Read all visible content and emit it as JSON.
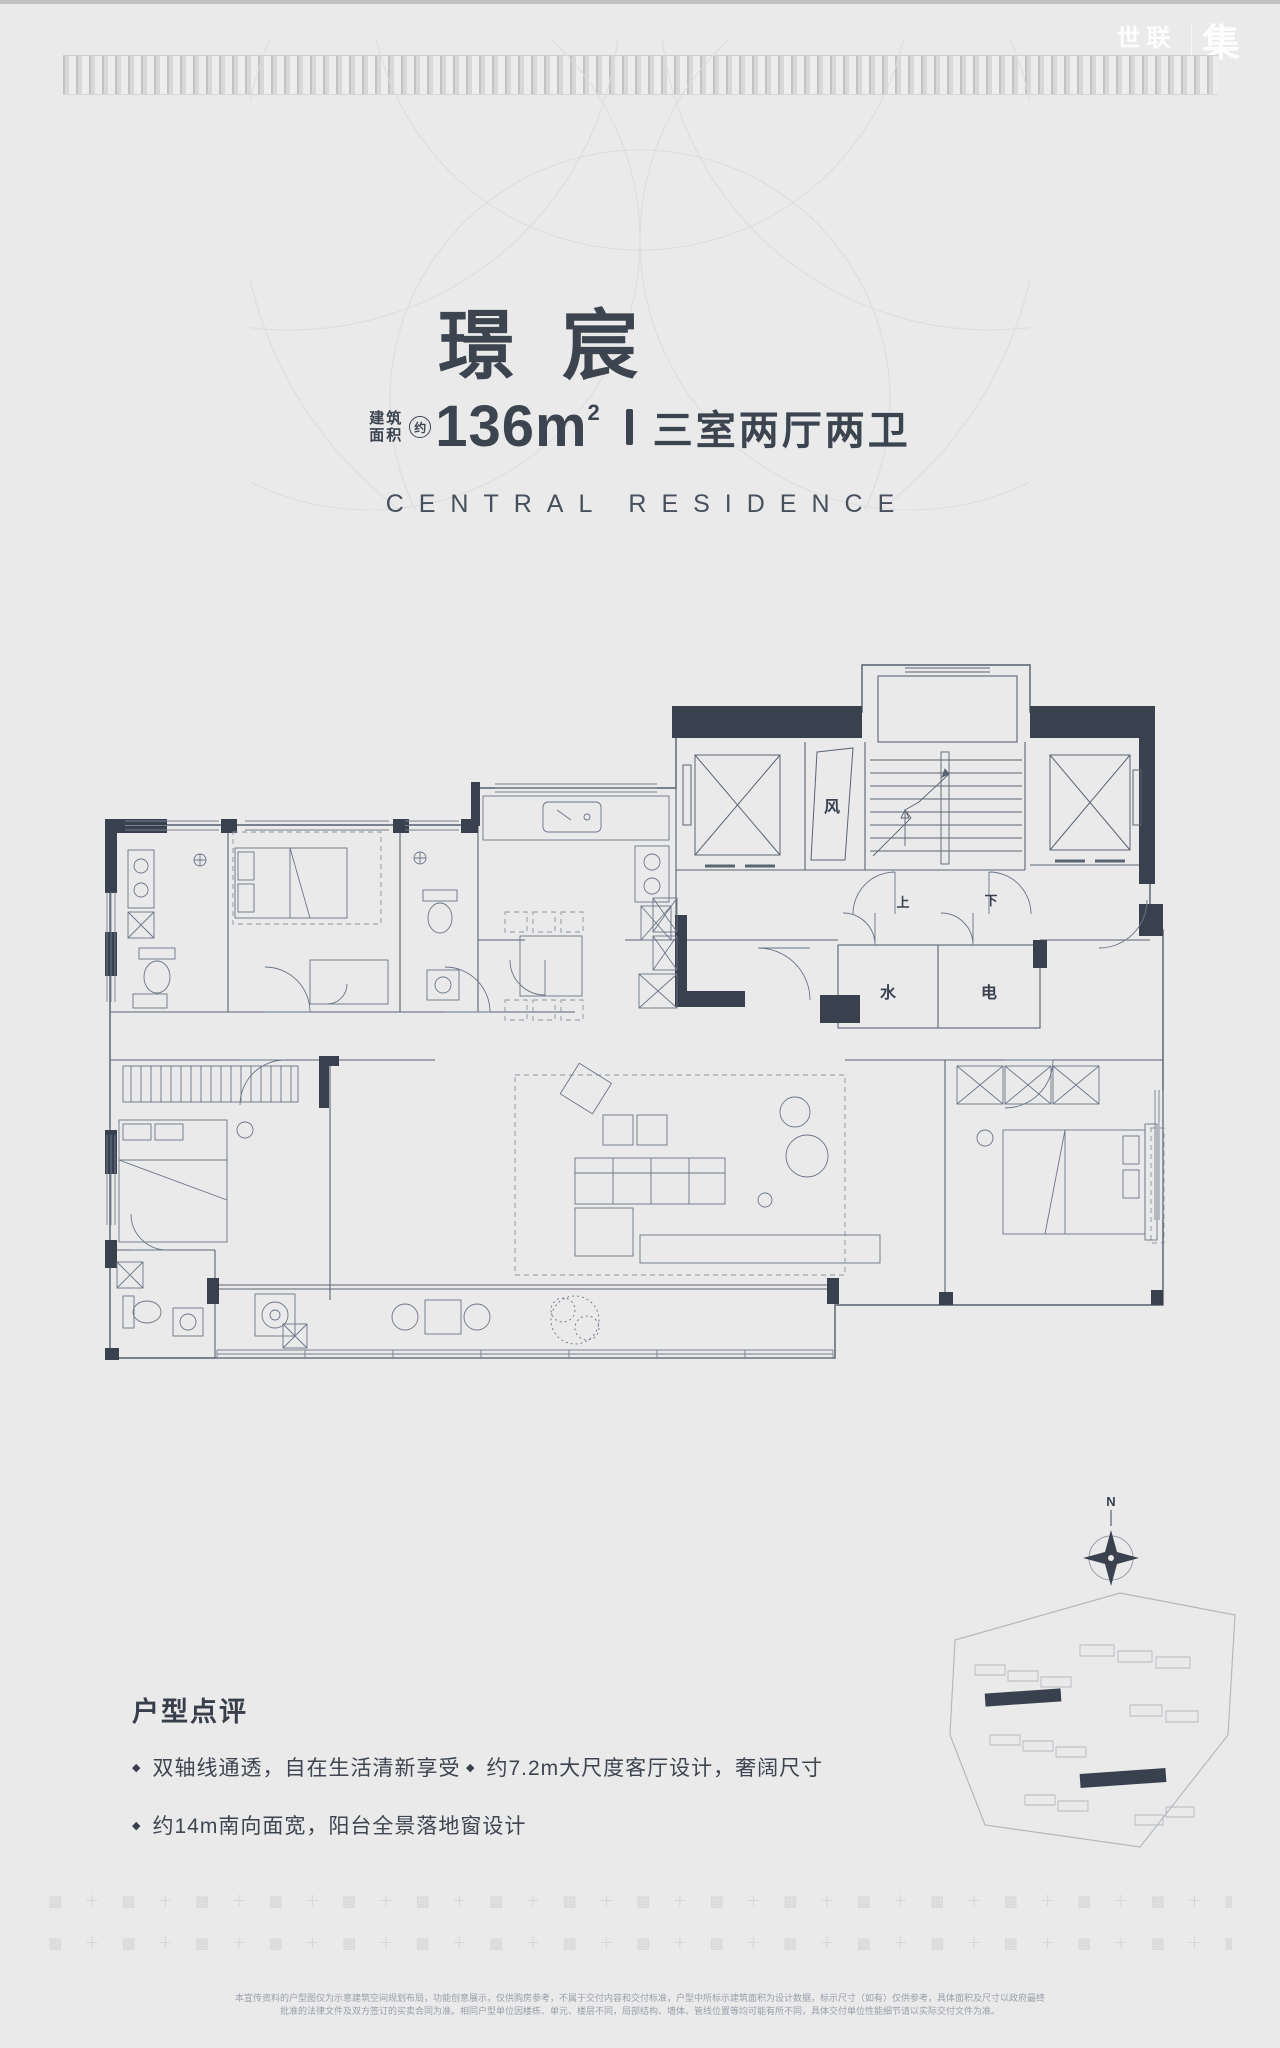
{
  "header": {
    "logo_cn": "世联",
    "logo_big": "集",
    "logo_sub": "worldunion.com"
  },
  "hero": {
    "title_chars": [
      "璟",
      "宸"
    ],
    "area_prefix_line1": "建筑",
    "area_prefix_line2": "面积",
    "area_approx": "约",
    "area_value": "136m",
    "area_sup": "2",
    "layout": "三室两厅两卫",
    "subtitle_en": "CENTRAL RESIDENCE"
  },
  "floorplan": {
    "labels": {
      "vent": "风",
      "up": "上",
      "down": "下",
      "water": "水",
      "electric": "电"
    },
    "compass_n": "N"
  },
  "review": {
    "heading": "户型点评",
    "bullets": [
      "双轴线通透，自在生活清新享受",
      "约7.2m大尺度客厅设计，奢阔尺寸",
      "约14m南向面宽，阳台全景落地窗设计"
    ]
  },
  "footer": {
    "disclaimer_line1": "本宣传资料的户型图仅为示意建筑空间规划布局，功能创意展示，仅供购房参考，不属于交付内容和交付标准，户型中所标示建筑面积为设计数据，标示尺寸（如有）仅供参考，具体面积及尺寸以政府最终",
    "disclaimer_line2": "批准的法律文件及双方签订的买卖合同为准。相同户型单位因楼栋、单元、楼层不同，局部结构、墙体、管线位置等均可能有所不同，具体交付单位性能细节请以实际交付文件为准。"
  },
  "decor": {
    "band_motif": "▩ ",
    "band_sep": "＋ ",
    "band_repeat": 40
  },
  "colors": {
    "page_bg": "#eaeaeb",
    "ink": "#3c4450",
    "wall_dark": "#39414f",
    "line": "#5a6472",
    "deco_gray": "#d6d6d8"
  }
}
